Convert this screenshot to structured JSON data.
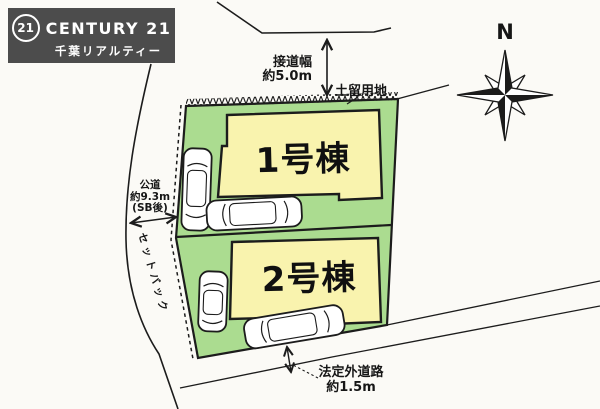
{
  "brand": {
    "seal": "21",
    "name": "CENTURY 21",
    "subtitle": "千葉リアルティー"
  },
  "compass": {
    "north": "N"
  },
  "buildings": [
    {
      "label": "1号棟"
    },
    {
      "label": "2号棟"
    }
  ],
  "labels": {
    "frontage": {
      "line1": "接道幅",
      "line2": "約5.0m"
    },
    "retaining_land": "土留用地",
    "public_road": {
      "line1": "公道",
      "line2": "約9.3m",
      "line3": "(SB後)"
    },
    "setback": "セットバック",
    "informal_road": {
      "line1": "法定外道路",
      "line2": "約1.5m"
    }
  },
  "colors": {
    "lot_green": "#abdc90",
    "building_yellow": "#f9f3ae",
    "line": "#1c1c1c",
    "logo_bg": "#4c4c4c",
    "car_fill": "#ffffff"
  }
}
